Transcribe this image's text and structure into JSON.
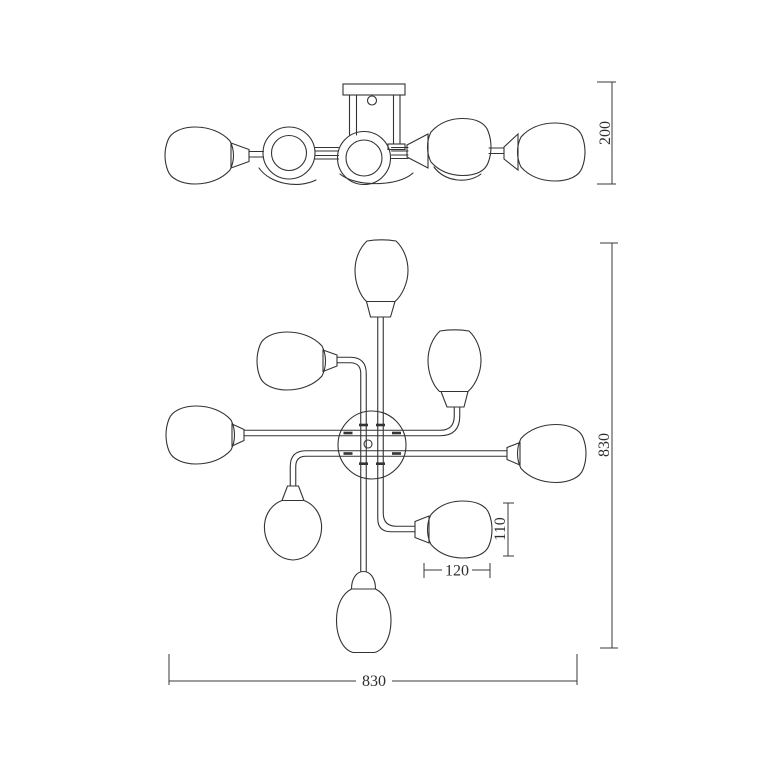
{
  "drawing": {
    "background_color": "#ffffff",
    "line_color": "#333333",
    "dimension_labels": {
      "fixture_height": "200",
      "plan_overall_height": "830",
      "shade_height": "110",
      "shade_width": "120",
      "plan_overall_width": "830"
    }
  }
}
